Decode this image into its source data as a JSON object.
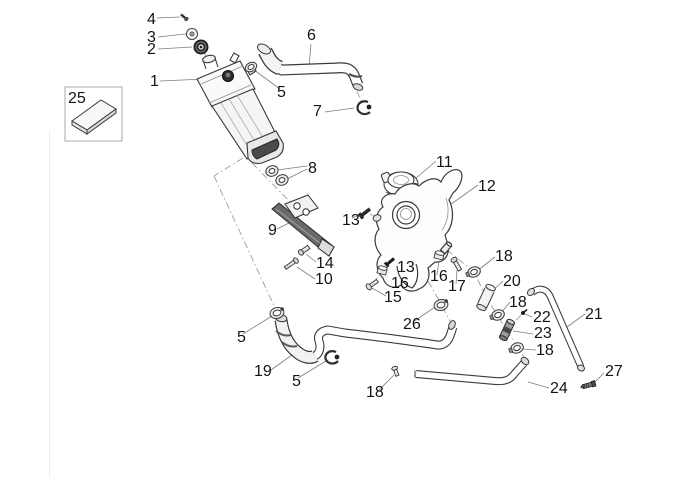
{
  "diagram": {
    "type": "exploded-parts-diagram",
    "background_color": "#ffffff",
    "ink_color": "#3a3a3a",
    "label_color": "#141414",
    "leader_color": "#7d7d7d",
    "centerline_color": "#9c9c9c",
    "callouts": [
      {
        "num": "1"
      },
      {
        "num": "2"
      },
      {
        "num": "3"
      },
      {
        "num": "4"
      },
      {
        "num": "5"
      },
      {
        "num": "5"
      },
      {
        "num": "5"
      },
      {
        "num": "6"
      },
      {
        "num": "7"
      },
      {
        "num": "8"
      },
      {
        "num": "9"
      },
      {
        "num": "10"
      },
      {
        "num": "11"
      },
      {
        "num": "12"
      },
      {
        "num": "13"
      },
      {
        "num": "13"
      },
      {
        "num": "14"
      },
      {
        "num": "15"
      },
      {
        "num": "16"
      },
      {
        "num": "16"
      },
      {
        "num": "17"
      },
      {
        "num": "18"
      },
      {
        "num": "18"
      },
      {
        "num": "18"
      },
      {
        "num": "18"
      },
      {
        "num": "19"
      },
      {
        "num": "20"
      },
      {
        "num": "21"
      },
      {
        "num": "22"
      },
      {
        "num": "23"
      },
      {
        "num": "24"
      },
      {
        "num": "25"
      },
      {
        "num": "26"
      },
      {
        "num": "27"
      }
    ]
  }
}
